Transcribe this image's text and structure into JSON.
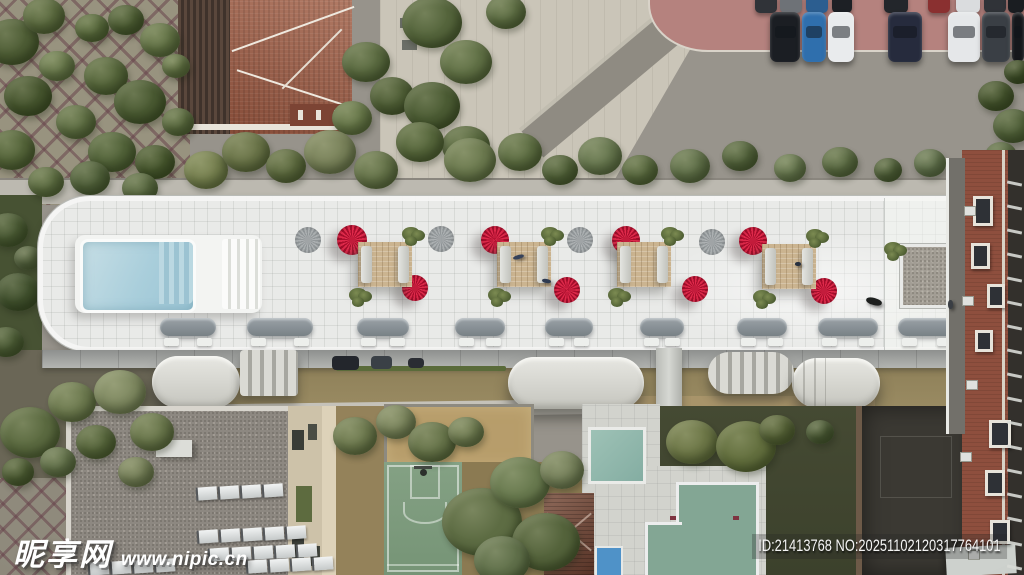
{
  "image": {
    "description": "Aerial top-down drone photo of a long white residential rooftop terrace with red fan umbrellas, a swimming pool, tan lounge decks and capsule balconies, surrounded by a tree park, terracotta-roof house, parking lot with cars, basketball court, pool house and two swimming pools",
    "width_px": 1024,
    "height_px": 575
  },
  "watermark": {
    "site_name": "昵享网",
    "site_url": "www.nipic.cn",
    "id_text": "ID:21413768 NO:20251102120317764101"
  },
  "colors": {
    "umbrella_red": "#c31834",
    "rooftop_white": "#e9eae8",
    "deck_tan": "#cbb490",
    "pool_blue": "#aacfdc",
    "small_pool_teal": "#8fb8ad",
    "big_pool_green": "#83a694",
    "kid_pool_blue": "#4f92c8",
    "terracotta_roof": "#9b5a43",
    "brick_facade": "#8e4f3e",
    "court_green": "#7d9b7d",
    "pink_paving": "#b5827e"
  },
  "scene": {
    "counts": {
      "red_umbrellas": 8,
      "gray_umbrellas": 4,
      "lounge_decks": 4,
      "vent_pods": 9,
      "parked_cars_front_row": 7
    },
    "tree_groups": {
      "trees-park": [
        [
          12,
          42,
          27,
          "#4e5d35"
        ],
        [
          44,
          16,
          21,
          "#5b6a3f"
        ],
        [
          28,
          96,
          24,
          "#46552e"
        ],
        [
          12,
          150,
          23,
          "#55653a"
        ],
        [
          57,
          66,
          18,
          "#68784b"
        ],
        [
          92,
          28,
          17,
          "#596a3d"
        ],
        [
          126,
          20,
          18,
          "#4d5d34"
        ],
        [
          160,
          40,
          20,
          "#637346"
        ],
        [
          106,
          76,
          22,
          "#56663b"
        ],
        [
          140,
          102,
          26,
          "#4a5a32"
        ],
        [
          76,
          122,
          20,
          "#5e6e43"
        ],
        [
          112,
          152,
          24,
          "#526339"
        ],
        [
          46,
          182,
          18,
          "#5d6d42"
        ],
        [
          155,
          162,
          20,
          "#47572e"
        ],
        [
          178,
          122,
          16,
          "#5b6b40"
        ],
        [
          176,
          66,
          14,
          "#657547"
        ],
        [
          90,
          178,
          20,
          "#50603a"
        ],
        [
          140,
          188,
          18,
          "#5a6a42"
        ],
        [
          8,
          230,
          20,
          "#4a5a34"
        ],
        [
          18,
          292,
          22,
          "#41512e"
        ],
        [
          6,
          342,
          18,
          "#4c5c36"
        ],
        [
          28,
          258,
          14,
          "#566441"
        ]
      ],
      "trees-plaza": [
        [
          366,
          62,
          24,
          "#5a6a40"
        ],
        [
          392,
          96,
          22,
          "#4f5e36"
        ],
        [
          432,
          22,
          30,
          "#55653c"
        ],
        [
          466,
          62,
          26,
          "#617146"
        ],
        [
          432,
          106,
          28,
          "#4c5c34"
        ],
        [
          466,
          146,
          24,
          "#58683e"
        ],
        [
          506,
          12,
          20,
          "#5e6e44"
        ],
        [
          352,
          118,
          20,
          "#677749"
        ]
      ],
      "trees-hedge": [
        [
          206,
          170,
          22,
          "#76804f"
        ],
        [
          246,
          152,
          24,
          "#6a7448"
        ],
        [
          286,
          166,
          20,
          "#5d6a3f"
        ],
        [
          330,
          152,
          26,
          "#79825a"
        ],
        [
          376,
          170,
          22,
          "#657349"
        ],
        [
          420,
          142,
          24,
          "#57673c"
        ],
        [
          470,
          160,
          26,
          "#6c7a4f"
        ],
        [
          520,
          152,
          22,
          "#5e6e43"
        ],
        [
          560,
          170,
          18,
          "#516139"
        ],
        [
          600,
          156,
          22,
          "#67774f"
        ],
        [
          640,
          170,
          18,
          "#59693f"
        ],
        [
          690,
          166,
          20,
          "#607049"
        ],
        [
          740,
          156,
          18,
          "#54643d"
        ],
        [
          790,
          168,
          16,
          "#697951"
        ],
        [
          840,
          162,
          18,
          "#5d6d45"
        ],
        [
          888,
          170,
          14,
          "#51613b"
        ],
        [
          930,
          163,
          16,
          "#63734f"
        ],
        [
          968,
          168,
          13,
          "#57673f"
        ]
      ],
      "trees-right": [
        [
          996,
          96,
          18,
          "#45542e"
        ],
        [
          1013,
          126,
          20,
          "#506039"
        ],
        [
          1001,
          156,
          16,
          "#5b6b44"
        ],
        [
          1018,
          72,
          14,
          "#3e4d29"
        ]
      ],
      "trees-bottom": [
        [
          30,
          432,
          30,
          "#5b6a40"
        ],
        [
          72,
          402,
          24,
          "#6d7a4f"
        ],
        [
          120,
          392,
          26,
          "#7f8961"
        ],
        [
          152,
          432,
          22,
          "#69764b"
        ],
        [
          96,
          442,
          20,
          "#56653b"
        ],
        [
          136,
          472,
          18,
          "#768059"
        ],
        [
          18,
          472,
          16,
          "#4e5d35"
        ],
        [
          58,
          462,
          18,
          "#62714a"
        ],
        [
          355,
          436,
          22,
          "#6e7a4f"
        ],
        [
          396,
          422,
          20,
          "#7b855d"
        ],
        [
          432,
          442,
          24,
          "#667349"
        ],
        [
          466,
          432,
          18,
          "#717d53"
        ],
        [
          482,
          522,
          40,
          "#5d6c43"
        ],
        [
          520,
          482,
          30,
          "#697a4f"
        ],
        [
          546,
          542,
          34,
          "#54633b"
        ],
        [
          502,
          560,
          28,
          "#60704a"
        ],
        [
          562,
          470,
          22,
          "#76815b"
        ],
        [
          692,
          442,
          26,
          "#6d7747"
        ],
        [
          746,
          446,
          30,
          "#636f3e"
        ],
        [
          777,
          430,
          18,
          "#586439"
        ],
        [
          820,
          432,
          14,
          "#4d5c38"
        ]
      ]
    },
    "umbrellas": {
      "red": [
        [
          352,
          240,
          15,
          0
        ],
        [
          415,
          288,
          13,
          40
        ],
        [
          495,
          240,
          14,
          15
        ],
        [
          567,
          290,
          13,
          65
        ],
        [
          626,
          240,
          14,
          30
        ],
        [
          695,
          289,
          13,
          80
        ],
        [
          753,
          241,
          14,
          10
        ],
        [
          824,
          291,
          13,
          50
        ]
      ],
      "gray": [
        [
          308,
          240,
          13
        ],
        [
          441,
          239,
          13
        ],
        [
          580,
          240,
          13
        ],
        [
          712,
          242,
          13
        ]
      ]
    },
    "deck_modules": [
      [
        358,
        242
      ],
      [
        497,
        242
      ],
      [
        617,
        242
      ],
      [
        762,
        244
      ]
    ],
    "extra_plants": [
      [
        884,
        242
      ]
    ],
    "vent_pods": [
      [
        160,
        56
      ],
      [
        247,
        66
      ],
      [
        357,
        52
      ],
      [
        455,
        50
      ],
      [
        545,
        48
      ],
      [
        640,
        44
      ],
      [
        737,
        50
      ],
      [
        818,
        60
      ],
      [
        898,
        58
      ]
    ],
    "parking": {
      "front": [
        [
          770,
          30,
          "#1b1e23"
        ],
        [
          802,
          24,
          "#2f6fad"
        ],
        [
          828,
          26,
          "#e9ebed"
        ],
        [
          888,
          34,
          "#262b3d"
        ],
        [
          948,
          32,
          "#e5e7e9"
        ],
        [
          982,
          28,
          "#3a3f45"
        ],
        [
          1012,
          12,
          "#15171b"
        ]
      ],
      "back": [
        [
          755,
          22,
          "#303338"
        ],
        [
          780,
          22,
          "#6e7277"
        ],
        [
          806,
          22,
          "#2c5e90"
        ],
        [
          832,
          20,
          "#1d2025"
        ],
        [
          884,
          24,
          "#23262b"
        ],
        [
          928,
          22,
          "#8a3030"
        ],
        [
          956,
          24,
          "#dadcde"
        ],
        [
          984,
          22,
          "#303338"
        ],
        [
          1008,
          16,
          "#1a1d21"
        ]
      ]
    },
    "shade_cars": [
      [
        332,
        356,
        27,
        14,
        "#23262c"
      ],
      [
        371,
        356,
        21,
        13,
        "#3a4046"
      ],
      [
        408,
        358,
        16,
        10,
        "#2a2d33"
      ]
    ],
    "skylight_rows": [
      [
        196,
        487,
        4
      ],
      [
        197,
        530,
        5
      ],
      [
        208,
        548,
        5
      ],
      [
        88,
        562,
        4
      ],
      [
        246,
        560,
        4
      ]
    ],
    "brick": {
      "windows": [
        [
          973,
          196,
          14,
          24
        ],
        [
          971,
          243,
          13,
          20
        ],
        [
          987,
          284,
          12,
          18
        ],
        [
          975,
          330,
          12,
          16
        ],
        [
          989,
          420,
          16,
          22
        ],
        [
          985,
          470,
          14,
          20
        ],
        [
          990,
          520,
          14,
          18
        ]
      ],
      "acs": [
        [
          964,
          206
        ],
        [
          962,
          296
        ],
        [
          966,
          380
        ],
        [
          960,
          452
        ],
        [
          968,
          550
        ]
      ],
      "rail_ys": [
        182,
        206,
        230,
        254,
        278,
        302,
        326,
        350,
        374,
        398,
        422,
        446,
        470,
        494,
        518,
        542,
        566
      ]
    },
    "figures": [
      [
        513,
        255,
        11,
        4,
        "#36425a",
        -15,
        "person-lying"
      ],
      [
        542,
        279,
        9,
        4,
        "#2e3a50",
        10,
        "person-lying"
      ],
      [
        866,
        298,
        16,
        7,
        "#1d1f1e",
        15,
        "dog"
      ],
      [
        948,
        300,
        5,
        9,
        "#3a3e44",
        0,
        "person-standing"
      ],
      [
        795,
        262,
        6,
        4,
        "#27303f",
        0,
        "person"
      ]
    ]
  }
}
